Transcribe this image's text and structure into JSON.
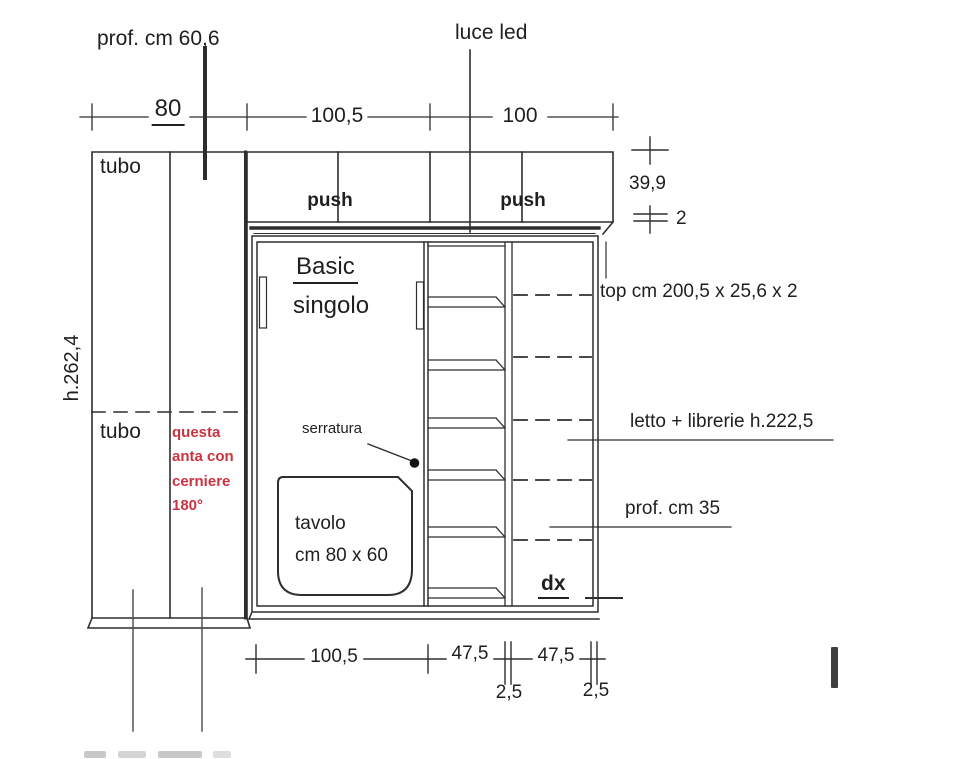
{
  "annotations": {
    "prof_top": "prof. cm 60,6",
    "luce_led": "luce led",
    "tubo_top": "tubo",
    "tubo_bottom": "tubo",
    "push_left": "push",
    "push_right": "push",
    "height_total": "h.262,4",
    "door_note_red": "questa anta con cerniere 180°",
    "basic_title": "Basic",
    "basic_subtitle": "singolo",
    "lock": "serratura",
    "table_line1": "tavolo",
    "table_line2": "cm 80 x 60",
    "top_panel": "top cm 200,5 x 25,6 x 2",
    "bed_bookcase": "letto + librerie h.222,5",
    "depth_note": "prof. cm 35",
    "side_marker": "dx"
  },
  "dimensions": {
    "top": [
      "80",
      "100,5",
      "100"
    ],
    "right": [
      "39,9",
      "2"
    ],
    "bottom": [
      "100,5",
      "47,5",
      "47,5"
    ],
    "bottom_offsets": [
      "2,5",
      "2,5"
    ]
  },
  "colors": {
    "line": "#2e2e2e",
    "red_note": "#cc3340",
    "background": "#ffffff"
  }
}
